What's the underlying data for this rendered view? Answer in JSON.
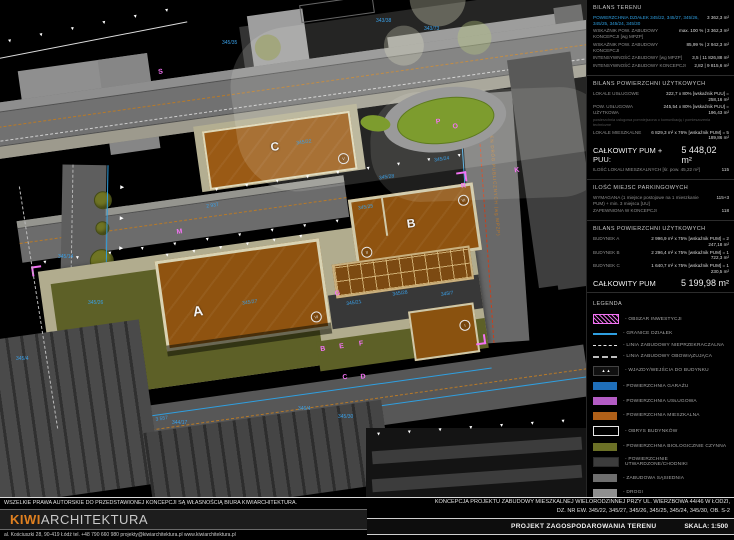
{
  "colors": {
    "background": "#000000",
    "parcel_blue": "#3aa0e8",
    "marker_magenta": "#f473f4",
    "building_brown": "#9a5a15",
    "bio_olive": "#5d6027",
    "pavement_khaki": "#b1ac8e",
    "garage_blue": "#1f6fba",
    "service_purple": "#b35cc4",
    "residential_orange": "#b06018",
    "logo_orange": "#e08020",
    "road_gray": "#6c6c6c"
  },
  "drawing": {
    "buildings": {
      "a": "A",
      "b": "B",
      "c": "C"
    },
    "parcels": [
      "345/35",
      "343/38",
      "343/73",
      "345/14",
      "345/26",
      "345/22",
      "345/27",
      "345/25",
      "345/28",
      "345/24",
      "345/21",
      "345/7",
      "345/4",
      "346/4",
      "344/17",
      "345/30"
    ],
    "markers": [
      "S",
      "M",
      "P",
      "O",
      "R",
      "K",
      "G",
      "B",
      "E",
      "F",
      "C",
      "D",
      "A"
    ],
    "romans": [
      "V",
      "VI",
      "II",
      "VI",
      "I"
    ],
    "street_label": "2KDD - TEREN DRÓG PUBLICZNYCH (wg MPZP)",
    "dims": [
      "2 937",
      "3 557"
    ],
    "icons": {
      "tri_down": "▼",
      "tri_right": "▶",
      "entry": "▲ ▲"
    }
  },
  "panels": {
    "bilans_terenu": {
      "title": "BILANS TERENU",
      "area_label_full": "POWIERZCHNIA DZIAŁEK 345/22, 345/27, 345/26, 345/25, 345/24, 345/30",
      "area_value": "3 362,3 m²",
      "rows": [
        {
          "label": "WSKAŹNIK POW. ZABUDOWY KONCEPCJI [wg MPZP]",
          "value": "max. 100 % | 3 362,3 m²"
        },
        {
          "label": "WSKAŹNIK POW. ZABUDOWY KONCEPCJI",
          "value": "85,99 % | 2 942,3 m²"
        },
        {
          "label": "INTENSYWNOŚĆ ZABUDOWY [wg MPZP]",
          "value": "3,5 | 11 826,88 m²"
        },
        {
          "label": "INTENSYWNOŚĆ ZABUDOWY KONCEPCJI",
          "value": "2,82 | 9 815,6 m²"
        }
      ]
    },
    "bilans_pum": {
      "title": "BILANS POWIERZCHNI UŻYTKOWYCH",
      "rows": [
        {
          "label": "LOKALE USŁUGOWE",
          "value": "322,7 x 80% [wskaźnik PUU] = 258,16 m²"
        },
        {
          "label": "POW. USŁUGOWA UŻYTKOWA",
          "value": "245,54 x 80% [wskaźnik PUU] = 196,43 m²"
        },
        {
          "label": "LOKALE MIESZKALNE",
          "value": "6 829,3 m² x 76% [wskaźnik PUM] = 5 189,86 m²"
        }
      ],
      "note": "powierzchnia usługowa pomniejszona o komunikację i pomieszczenia techniczne",
      "total_label": "CAŁKOWITY PUM + PUU:",
      "total_value": "5 448,02 m²",
      "units_label": "ILOŚĆ LOKALI MIESZKALNYCH [śr. pow. 45,22 m²]",
      "units_value": "115"
    },
    "parking": {
      "title": "ILOŚĆ MIEJSC PARKINGOWYCH",
      "rows": [
        {
          "label": "WYMAGANA (1 miejsce postojowe na 1 mieszkanie PUM) + min. 3 miejsca [UU]",
          "value": "115+3"
        },
        {
          "label": "ZAPEWNIONA W KONCEPCJI",
          "value": "118"
        }
      ]
    },
    "bilans_budynki": {
      "title": "BILANS POWIERZCHNI UŻYTKOWYCH",
      "rows": [
        {
          "label": "BUDYNEK A",
          "value": "2 996,9 m² x 75% [wskaźnik PUM] = 2 247,18 m²"
        },
        {
          "label": "BUDYNEK B",
          "value": "2 296,4 m² x 75% [wskaźnik PUM] = 1 722,3 m²"
        },
        {
          "label": "BUDYNEK C",
          "value": "1 640,7 m² x 75% [wskaźnik PUM] = 1 230,5 m²"
        }
      ],
      "total_label": "CAŁKOWITY PUM",
      "total_value": "5 199,98 m²"
    }
  },
  "legend": {
    "title": "LEGENDA",
    "items": [
      {
        "label": "- OBSZAR INWESTYCJI"
      },
      {
        "label": "- GRANICE DZIAŁEK"
      },
      {
        "label": "- LINIA ZABUDOWY NIEPRZEKRACZALNA"
      },
      {
        "label": "- LINIA ZABUDOWY OBOWIĄZUJĄCA"
      },
      {
        "label": "- WJAZDY/WEJŚCIA DO BUDYNKU",
        "icon": "▲ ▲"
      },
      {
        "label": "- POWIERZCHNIA GARAŻU"
      },
      {
        "label": "- POWIERZCHNIA USŁUGOWA"
      },
      {
        "label": "- POWIERZCHNIA MIESZKALNA"
      },
      {
        "label": "- OBRYS BUDYNKÓW"
      },
      {
        "label": "- POWIERZCHNIA BIOLOGICZNIE CZYNNA"
      },
      {
        "label": "- POWIERZCHNIE UTWARDZONE/CHODNIKI"
      },
      {
        "label": "- ZABUDOWA SĄSIEDNIA"
      },
      {
        "label": "- DROGI"
      },
      {
        "label": "- RAMPA"
      },
      {
        "label": "- DRZEWA"
      }
    ]
  },
  "footer": {
    "copyright": "WSZELKIE PRAWA AUTORSKIE DO PRZEDSTAWIONEJ KONCEPCJI SĄ WŁASNOŚCIĄ BIURA KIWIARCHITEKTURA.",
    "logo_kiwi": "KIWI",
    "logo_rest": "ARCHITEKTURA",
    "address": "al. Kościuszki 28, 90-419 Łódź    tel. +48 790 660 980    projekty@kiwiarchitektura.pl    www.kiwiarchitektura.pl",
    "title_line1": "KONCEPCJA PROJEKTU ZABUDOWY MIESZKALNEJ WIELORODZINNEJ PRZY UL. WIERZBOWA 44/46 W ŁODZI,",
    "title_line2": "DZ. NR EW. 345/22, 345/27, 345/26, 345/25, 345/24, 345/30, OB. S-2",
    "drawing_name": "PROJEKT ZAGOSPODAROWANIA TERENU",
    "scale": "SKALA: 1:500"
  }
}
